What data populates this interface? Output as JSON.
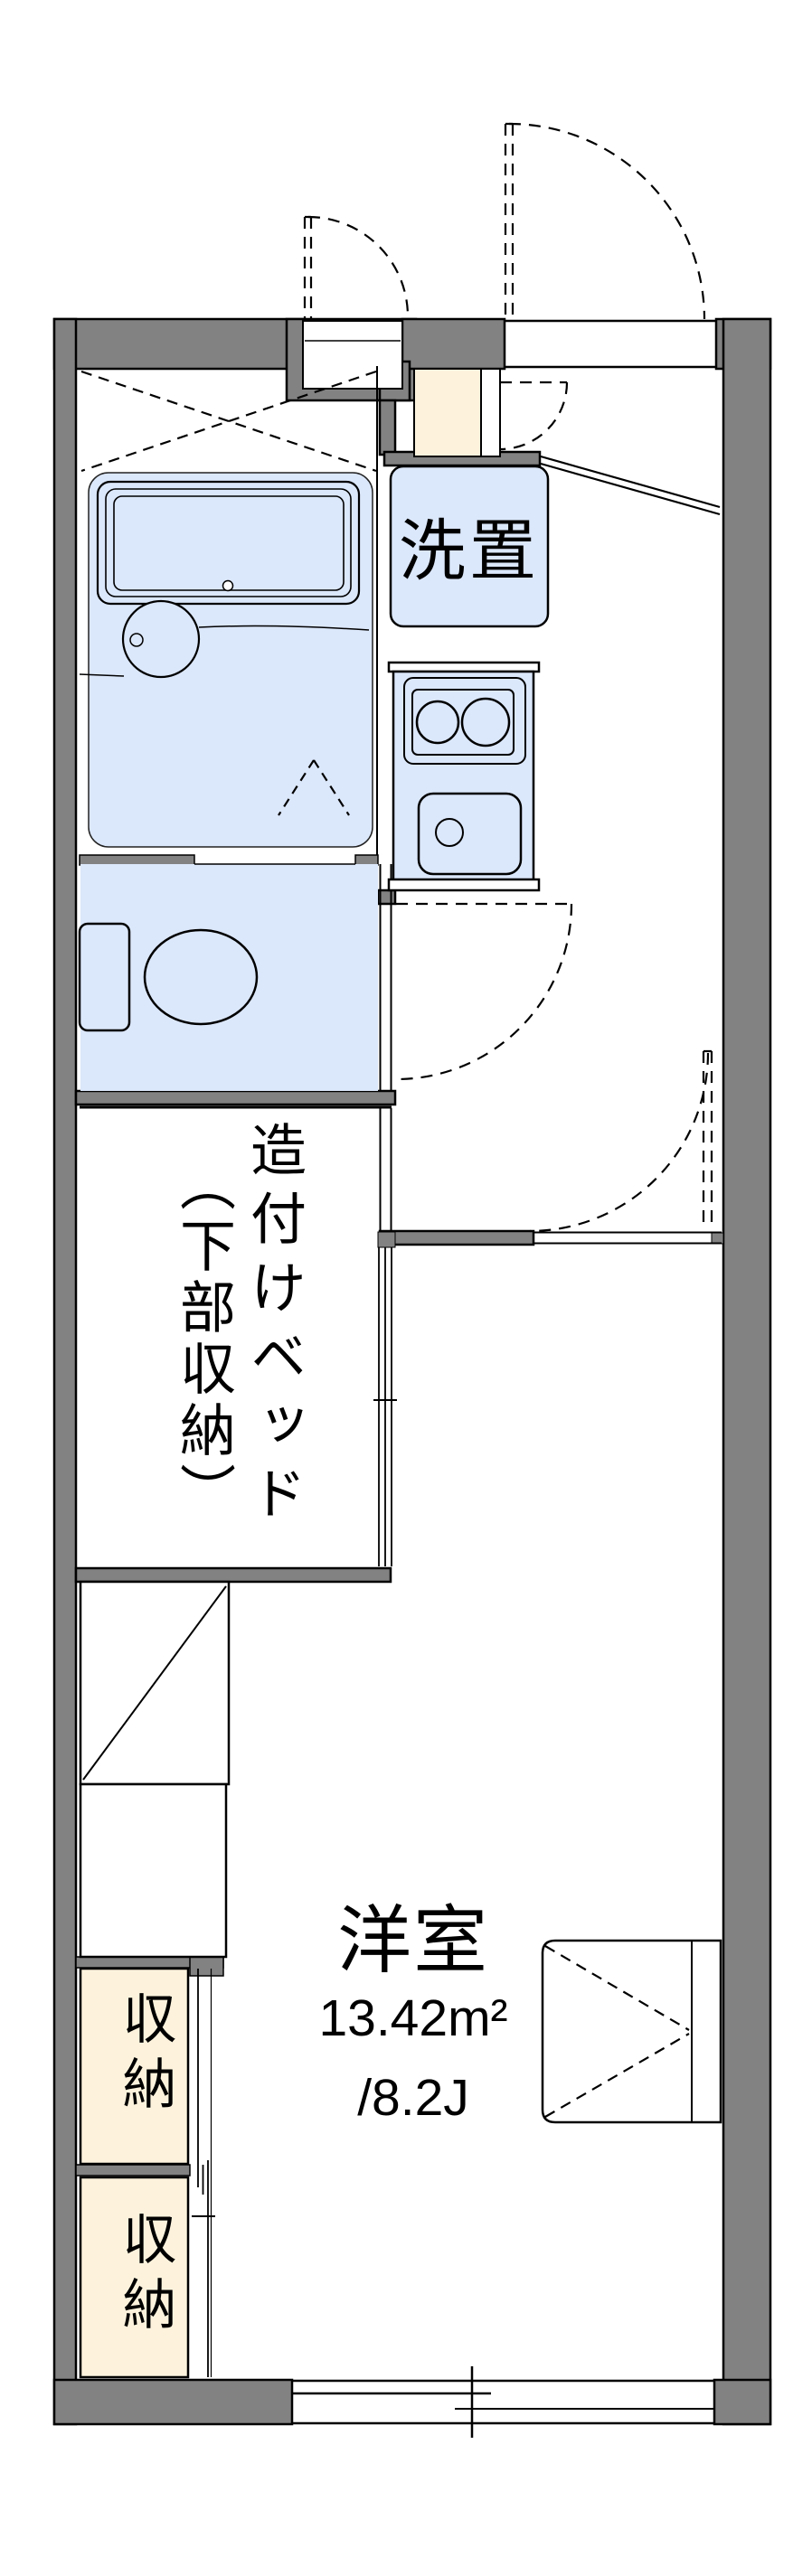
{
  "labels": {
    "washer": "洗置",
    "bed_line1": "造付けベッド",
    "bed_line2": "（下部収納）",
    "room_name": "洋室",
    "room_area": "13.42m²",
    "room_jo": "/8.2J",
    "storage1": "収納",
    "storage2": "収納"
  },
  "colors": {
    "wall_gray": "#828282",
    "fixture_blue": "#dbe7fa",
    "storage_cream": "#fdf3dd",
    "line_black": "#000000",
    "background": "#ffffff"
  }
}
